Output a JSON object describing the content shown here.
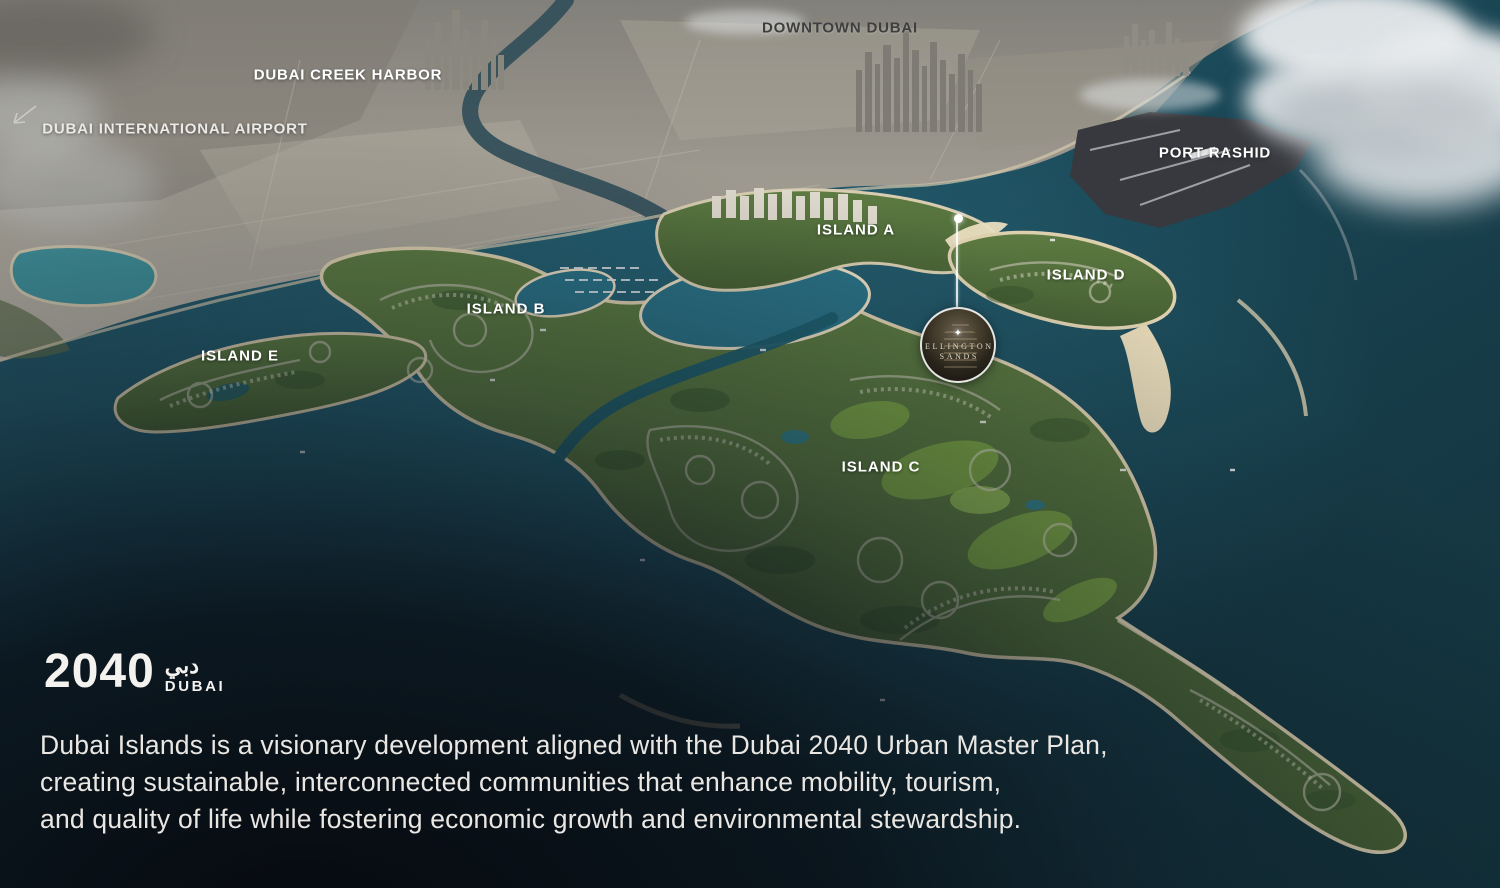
{
  "labels": {
    "city": [
      {
        "id": "downtown-dubai",
        "text": "DOWNTOWN DUBAI"
      },
      {
        "id": "dubai-creek-harbor",
        "text": "DUBAI CREEK HARBOR"
      },
      {
        "id": "dubai-international-airport",
        "text": "DUBAI INTERNATIONAL AIRPORT"
      },
      {
        "id": "port-rashid",
        "text": "PORT RASHID"
      }
    ],
    "islands": [
      {
        "id": "island-a",
        "text": "ISLAND A"
      },
      {
        "id": "island-b",
        "text": "ISLAND B"
      },
      {
        "id": "island-c",
        "text": "ISLAND C"
      },
      {
        "id": "island-d",
        "text": "ISLAND D"
      },
      {
        "id": "island-e",
        "text": "ISLAND E"
      }
    ]
  },
  "marker": {
    "star_glyph": "✦",
    "line1": "ELLINGTON",
    "line2": "SANDS"
  },
  "branding": {
    "logo_number": "2040",
    "logo_arabic": "دبي",
    "logo_word": "DUBAI"
  },
  "footer": {
    "paragraph_lines": [
      "Dubai Islands is a visionary development aligned with the Dubai 2040 Urban Master Plan,",
      "creating sustainable, interconnected communities that enhance mobility, tourism,",
      "and quality of life while fostering economic growth and environmental stewardship."
    ]
  },
  "colors": {
    "water_deep": "#13333e",
    "water_teal": "#2a7084",
    "sand": "#ddd0ae",
    "island_green": "#54743e",
    "city_gray": "#a8a399",
    "label_white": "#ffffff",
    "label_dark": "#3e3e3e",
    "body_text": "#eae7e3"
  }
}
